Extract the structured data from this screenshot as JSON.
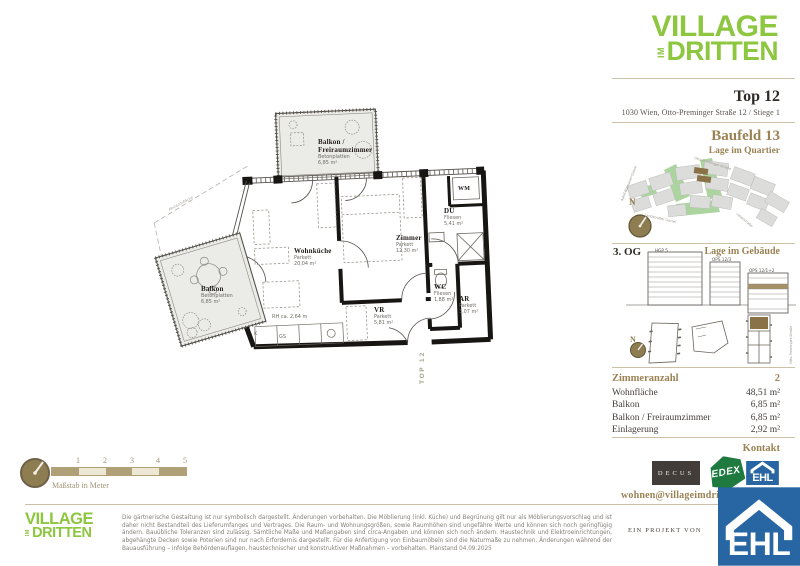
{
  "brand": {
    "line1": "VILLAGE",
    "im": "IM",
    "line2": "DRITTEN"
  },
  "header": {
    "title": "Top 12",
    "address": "1030 Wien, Otto-Preminger Straße 12 / Stiege 1"
  },
  "quartier": {
    "heading": "Baufeld 13",
    "subheading": "Lage im Quartier",
    "compass": "N",
    "streets": {
      "top": "Otto-Preminger-Straße",
      "left": "Adolf-Blamauer-Gasse",
      "bottom_left": "Landstraßer Gürtel",
      "bottom_right": "Leberstraße"
    }
  },
  "gebaeude": {
    "floor": "3. OG",
    "heading": "Lage im Gebäude",
    "compass": "N",
    "buildings": [
      "HGP 5",
      "OPS 12/3",
      "OPS 12/1+2"
    ],
    "street_right": "Otto-Preminger-Straße"
  },
  "details": {
    "rows": [
      {
        "label": "Zimmeranzahl",
        "value": "2"
      },
      {
        "label": "Wohnfläche",
        "value": "48,51 m²"
      },
      {
        "label": "Balkon",
        "value": "6,85 m²"
      },
      {
        "label": "Balkon / Freiraumzimmer",
        "value": "6,85 m²"
      },
      {
        "label": "Einlagerung",
        "value": "2,92 m²"
      }
    ]
  },
  "kontakt": {
    "heading": "Kontakt",
    "email": "wohnen@villageimdritten.at",
    "partners": [
      "DECUS",
      "EDEX",
      "EHL"
    ],
    "project_note": "EIN PROJEKT VON"
  },
  "floorplan": {
    "rooms": [
      {
        "name_line1": "Balkon /",
        "name_line2": "Freiraumzimmer",
        "floor": "Betonplatten",
        "area": "6,85 m²"
      },
      {
        "name": "Wohnküche",
        "floor": "Parkett",
        "area": "20,04 m²"
      },
      {
        "name": "Zimmer",
        "floor": "Parkett",
        "area": "12,30 m²"
      },
      {
        "name": "DU",
        "floor": "Fliesen",
        "area": "5,41 m²"
      },
      {
        "name": "WC",
        "floor": "Fliesen",
        "area": "1,88 m²"
      },
      {
        "name": "AR",
        "floor": "Parkett",
        "area": "3,07 m²"
      },
      {
        "name": "VR",
        "floor": "Parkett",
        "area": "5,81 m²"
      },
      {
        "name": "Balkon",
        "floor": "Betonplatten",
        "area": "6,85 m²"
      }
    ],
    "labels": {
      "wm": "WM",
      "k": "K",
      "gs": "GS",
      "rh": "RH ca. 2,64 m",
      "top_unit": "TOP 12",
      "boundary": "Abstandsfläche"
    }
  },
  "scalebar": {
    "ticks": [
      "1",
      "2",
      "3",
      "4",
      "5"
    ],
    "caption": "Maßstab in Meter"
  },
  "footer": {
    "disclaimer": "Die gärtnerische Gestaltung ist nur symbolisch dargestellt. Änderungen vorbehalten. Die Möblierung (inkl. Küche) und Begrünung gilt nur als Möblierungsvorschlag und ist daher nicht Bestandteil des Lieferumfanges und Vertrages. Die Raum- und Wohnungsgrößen, sowie Raumhöhen sind ungefähre Werte und können sich noch geringfügig ändern. Bauübliche Toleranzen sind zulässig. Sämtliche Maße und Maßangaben sind circa-Angaben und können sich noch ändern. Haustechnik und Elektroeinrichtungen, abgehängte Decken sowie Poterien sind nur nach Erfordernis dargestellt. Für die Anfertigung von Einbaumöbeln sind die Naturmaße zu nehmen. Änderungen während der Bauausführung – infolge Behördenauflagen, haustechnischer und konstruktiver Maßnahmen – vorbehalten. Planstand 04.09.2025"
  }
}
